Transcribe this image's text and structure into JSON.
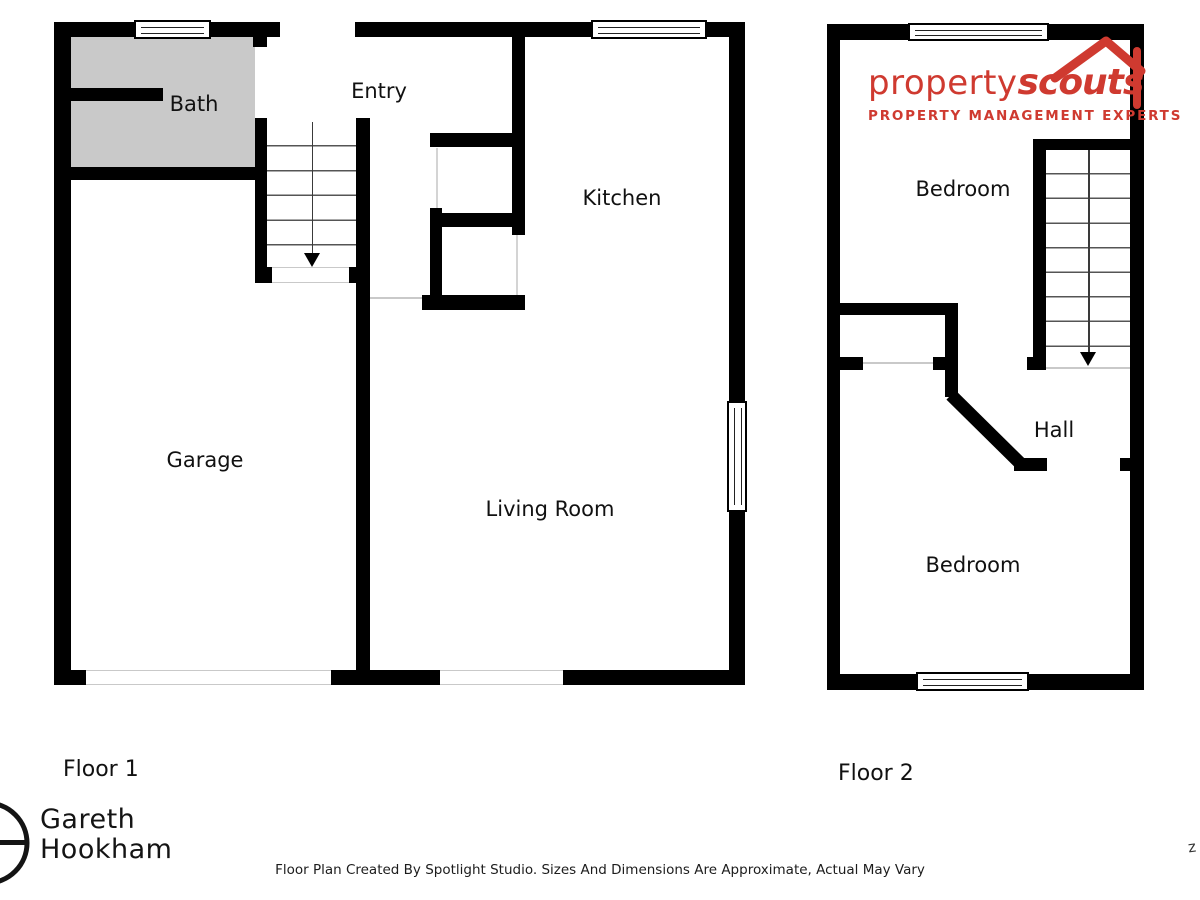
{
  "floor1": {
    "label": "Floor 1",
    "rooms": [
      {
        "name": "Bath"
      },
      {
        "name": "Entry"
      },
      {
        "name": "Kitchen"
      },
      {
        "name": "Garage"
      },
      {
        "name": "Living Room"
      }
    ]
  },
  "floor2": {
    "label": "Floor 2",
    "rooms": [
      {
        "name": "Bedroom"
      },
      {
        "name": "Hall"
      },
      {
        "name": "Bedroom"
      }
    ]
  },
  "branding": {
    "agency": {
      "word1": "property",
      "word2": "scouts",
      "tagline": "PROPERTY MANAGEMENT EXPERTS",
      "color": "#cf3a30"
    },
    "agent": {
      "line1": "Gareth",
      "line2": "Hookham"
    }
  },
  "footer": {
    "disclaimer": "Floor Plan Created By Spotlight Studio. Sizes And Dimensions Are Approximate, Actual May Vary",
    "edge_mark": "z"
  },
  "colors": {
    "wall": "#000000",
    "bath_fill": "#c9c9c9",
    "logo_red": "#cf3a30"
  }
}
